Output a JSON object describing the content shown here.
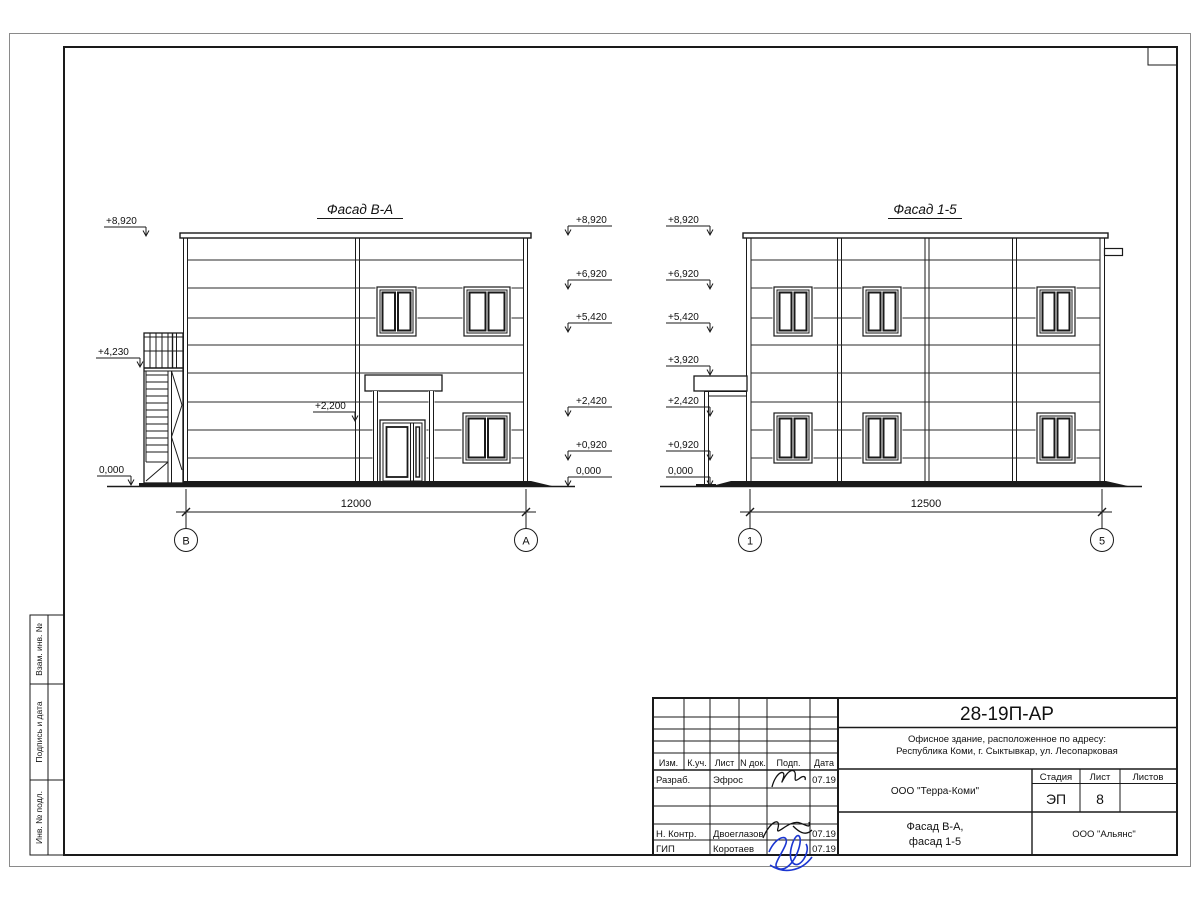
{
  "title_block": {
    "code": "28-19П-АР",
    "address_line1": "Офисное здание, расположенное по адресу:",
    "address_line2": "Республика Коми, г. Сыктывкар, ул. Лесопарковая",
    "client": "ООО \"Терра-Коми\"",
    "contractor": "ООО \"Альянс\"",
    "drawing_title_line1": "Фасад В-А,",
    "drawing_title_line2": "фасад 1-5",
    "stage_label": "Стадия",
    "sheet_label": "Лист",
    "sheets_label": "Листов",
    "stage_value": "ЭП",
    "sheet_value": "8",
    "sheets_value": "",
    "columns": [
      "Изм.",
      "К.уч.",
      "Лист",
      "N док.",
      "Подп.",
      "Дата"
    ],
    "rows": [
      {
        "role": "Разраб.",
        "name": "Эфрос",
        "date": "07.19"
      },
      {
        "role": "Н. Контр.",
        "name": "Двоеглазов",
        "date": "07.19"
      },
      {
        "role": "ГИП",
        "name": "Коротаев",
        "date": "07.19"
      }
    ]
  },
  "side_labels": [
    "Взам. инв. №",
    "Подпись и дата",
    "Инв. № подл."
  ],
  "facade_left": {
    "title": "Фасад В-А",
    "dimension": "12000",
    "axes": [
      "В",
      "А"
    ],
    "elevations_left": [
      "+8,920",
      "+4,230",
      "0,000"
    ],
    "elevation_canopy": "+2,200",
    "elevations_right": [
      "+8,920",
      "+6,920",
      "+5,420",
      "+2,420",
      "+0,920",
      "0,000"
    ]
  },
  "facade_right": {
    "title": "Фасад 1-5",
    "dimension": "12500",
    "axes": [
      "1",
      "5"
    ],
    "elevations_left": [
      "+8,920",
      "+6,920",
      "+5,420",
      "+3,920",
      "+2,420",
      "+0,920",
      "0,000"
    ]
  }
}
